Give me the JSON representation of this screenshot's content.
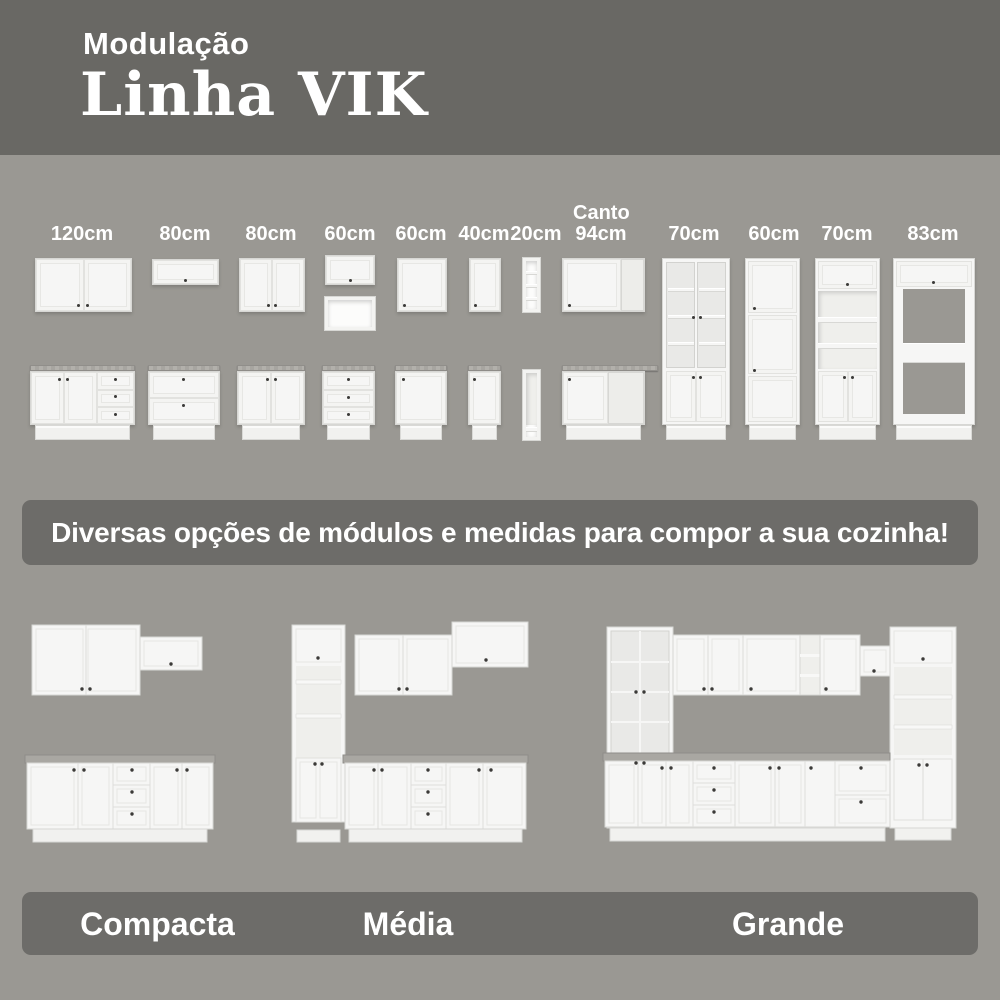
{
  "header": {
    "kicker": "Modulação",
    "title": "Linha VIK"
  },
  "modules": {
    "items": [
      {
        "id": "wall-two-door-120",
        "label": "120cm"
      },
      {
        "id": "wall-flip-door-80",
        "label": "80cm"
      },
      {
        "id": "wall-two-door-80",
        "label": "80cm"
      },
      {
        "id": "wall-flip-plus-niche-60",
        "label": "60cm"
      },
      {
        "id": "wall-one-door-60",
        "label": "60cm"
      },
      {
        "id": "wall-one-door-40",
        "label": "40cm"
      },
      {
        "id": "open-shelf-20",
        "label": "20cm"
      },
      {
        "id": "corner-94",
        "label": "Canto 94cm"
      },
      {
        "id": "tall-glass-cabinet-70",
        "label": "70cm"
      },
      {
        "id": "tall-pantry-60",
        "label": "60cm"
      },
      {
        "id": "tall-open-tower-70",
        "label": "70cm"
      },
      {
        "id": "tall-oven-tower-83",
        "label": "83cm"
      }
    ]
  },
  "banner": {
    "text": "Diversas opções de módulos e medidas para compor a sua cozinha!"
  },
  "kitchens": {
    "items": [
      {
        "label": "Compacta"
      },
      {
        "label": "Média"
      },
      {
        "label": "Grande"
      }
    ]
  },
  "colors": {
    "header_bg": "#696864",
    "page_bg": "#9a9893",
    "band_bg": "#6d6c69",
    "text": "#ffffff"
  }
}
